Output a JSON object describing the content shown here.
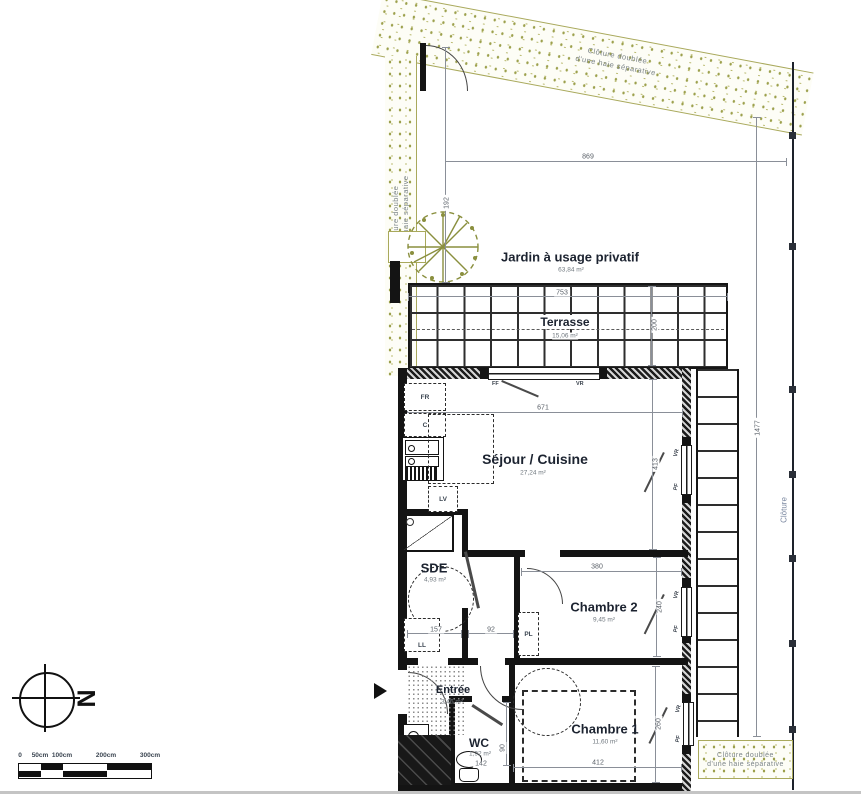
{
  "rooms": {
    "jardin": {
      "label": "Jardin à usage privatif",
      "area": "63,84 m²"
    },
    "terrasse": {
      "label": "Terrasse",
      "area": "15,06 m²"
    },
    "sejour": {
      "label": "Séjour / Cuisine",
      "area": "27,24 m²"
    },
    "sde": {
      "label": "SDE",
      "area": "4,93 m²"
    },
    "chambre2": {
      "label": "Chambre 2",
      "area": "9,45 m²"
    },
    "chambre1": {
      "label": "Chambre 1",
      "area": "11,60 m²"
    },
    "entree": {
      "label": "Entrée",
      "area": "3,46 m²"
    },
    "wc": {
      "label": "WC",
      "area": "1,92 m²"
    }
  },
  "dims": {
    "site_width": "869",
    "gate_offset": "192",
    "site_height": "1477",
    "terrace_width": "753",
    "terrace_depth": "200",
    "sejour_width": "671",
    "sejour_height": "413",
    "ch2_width": "380",
    "ch2_height": "240",
    "hall_left": "157",
    "hall_right": "92",
    "wc_width": "142",
    "wc_height": "90",
    "ch1_width": "412",
    "ch1_height": "260"
  },
  "labels": {
    "north": "N",
    "cloture": "Clôture",
    "hedge1": "Clôture doublée",
    "hedge2": "d'une haie séparative",
    "ff": "FF",
    "vr": "VR",
    "pf": "PF",
    "fr": "FR",
    "c": "C",
    "lv": "LV",
    "ll": "LL",
    "pl": "PL"
  },
  "scalebar": {
    "ticks": [
      "0",
      "50cm",
      "100cm",
      "200cm",
      "300cm"
    ]
  },
  "colors": {
    "hedge": "#9ca04c",
    "wall": "#141414",
    "dim": "#8a8f98"
  }
}
